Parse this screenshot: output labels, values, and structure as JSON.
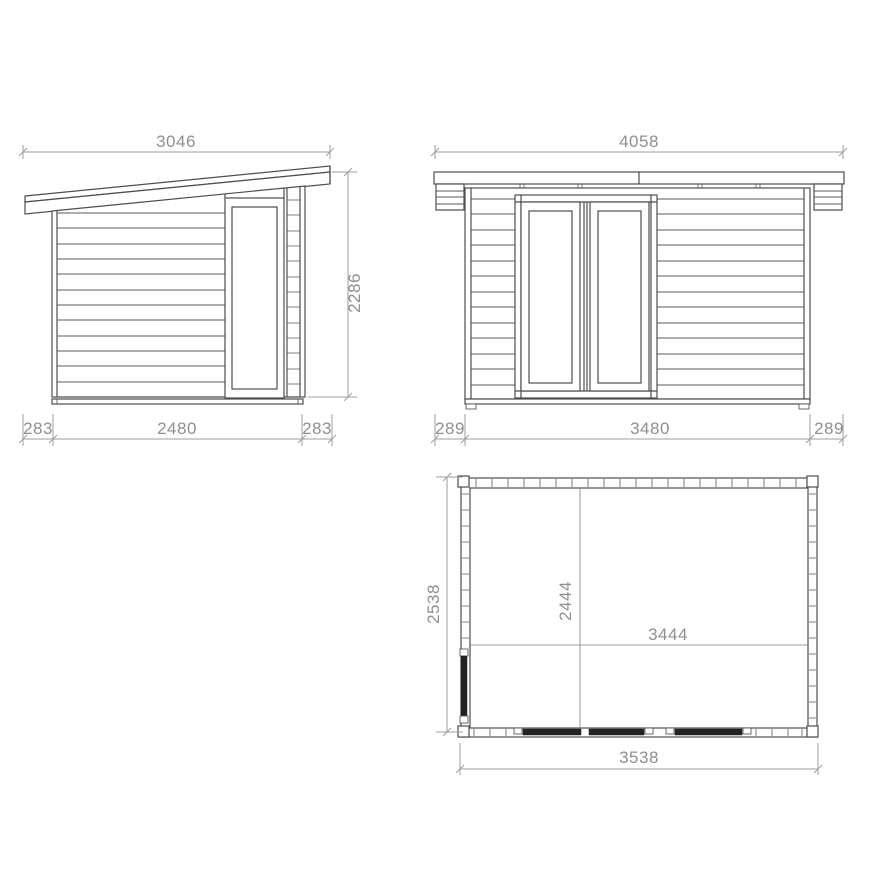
{
  "views": {
    "side_elevation": {
      "overall_width": "3046",
      "overall_height": "2286",
      "left_overhang": "283",
      "wall_length": "2480",
      "right_overhang": "283"
    },
    "front_elevation": {
      "overall_width": "4058",
      "left_overhang": "289",
      "wall_length": "3480",
      "right_overhang": "289"
    },
    "floor_plan": {
      "overall_depth": "2538",
      "internal_depth": "2444",
      "internal_width": "3444",
      "overall_width": "3538"
    }
  },
  "colors": {
    "line": "#4d4d4d",
    "dimension_line": "#9d9d9d",
    "dimension_text": "#8f8f8f",
    "background": "#ffffff"
  }
}
